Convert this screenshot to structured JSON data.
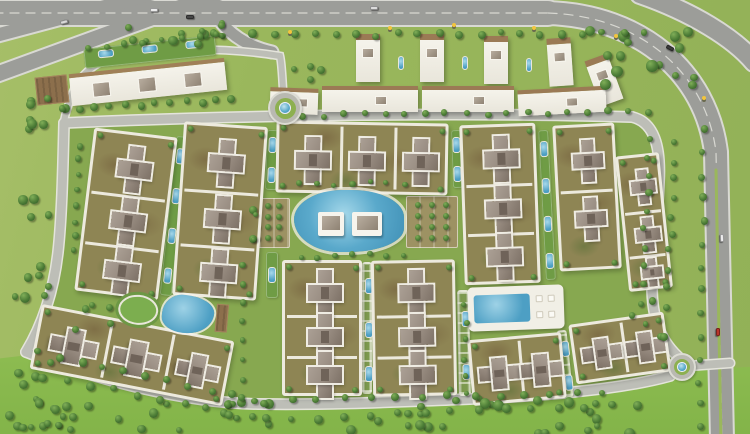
{
  "meta": {
    "alt": "Aerial master plan rendering of a gated residential compound: apartment clusters around a central lagoon pool and clubhouse, linear garden parks, perimeter loop road with two fountain roundabouts, commercial strip and villas row along a top highway, and tree-dotted green fields"
  },
  "palette": {
    "grass_base": "#9ab75c",
    "grass_field": "#8aba4e",
    "grass_inner": "#87a850",
    "road_major": "#9c9d99",
    "road_major_edge": "#d9d9d3",
    "road_minor": "#bdbeb7",
    "road_minor_edge": "#e4e4db",
    "plinth": "#edeade",
    "cluster_olive": "#8e8554",
    "cluster_brown": "#897a51",
    "building_gray": "#978b80",
    "building_dark": "#6f6359",
    "pool_blue": "#4d9fc4",
    "pool_light": "#a5d8ea",
    "tree_dark": "#2f5526",
    "tree_mid": "#4c7c36",
    "tree_light": "#7fae58",
    "garden_olive": "#9d9263",
    "deck_brown": "#8c6f4c",
    "white": "#f6f4ed"
  },
  "roads": {
    "interior": "M 66 122 C 240 114 470 111 632 117 C 656 122 662 148 659 184 C 656 232 652 262 652 288 C 652 318 662 342 684 360 C 640 384 545 397 470 400 C 392 403 330 406 258 405 C 186 404 96 380 28 352 C 45 322 55 288 59 252 C 63 216 65 164 66 122 Z",
    "major": [
      {
        "d": "M -6 13 L 548 13",
        "w": 24
      },
      {
        "d": "M 548 13 C 640 16 706 72 716 152 L 722 440",
        "w": 22
      },
      {
        "d": "M 640 -6 C 692 12 734 38 754 62",
        "w": 18
      },
      {
        "d": "M -6 36 L 152 -6",
        "w": 13
      },
      {
        "d": "M -8 76 L 228 -10",
        "w": 15
      },
      {
        "d": "M 206 -4 C 216 22 236 44 272 52",
        "w": 11
      }
    ],
    "lane_lines": [
      "M -6 13 L 548 13",
      "M 548 13 C 640 16 706 72 716 152 L 722 440"
    ],
    "median": {
      "d": "M 716 170 L 721 440",
      "w": 3
    },
    "minor": [
      {
        "d": "M 64 123 C 240 115 470 112 632 117",
        "w": 9
      },
      {
        "d": "M 632 117 C 654 122 661 146 659 182 C 657 230 652 262 652 286 C 652 318 660 342 682 360",
        "w": 9
      },
      {
        "d": "M 670 376 C 620 390 540 396 470 399 C 392 402 330 405 258 404 C 186 403 96 380 26 352",
        "w": 9
      },
      {
        "d": "M 26 352 C 44 322 54 288 58 252 C 62 216 63 164 64 123",
        "w": 9
      },
      {
        "d": "M 284 104 C 282 76 282 64 280 56 C 230 48 160 46 112 58",
        "w": 6
      },
      {
        "d": "M 112 58 C 90 64 76 80 70 100 C 67 110 65 114 64 122",
        "w": 6
      },
      {
        "d": "M 285 112 L 287 124",
        "w": 6
      },
      {
        "d": "M 688 366 L 730 363",
        "w": 8
      }
    ]
  },
  "roundabouts": [
    {
      "cx": 285,
      "cy": 108,
      "r": 17
    },
    {
      "cx": 682,
      "cy": 367,
      "r": 14
    }
  ],
  "clusters": [
    {
      "x": 84,
      "y": 132,
      "w": 84,
      "h": 164,
      "rot": 7,
      "crosses": [
        [
          42,
          34
        ],
        [
          42,
          86
        ],
        [
          42,
          136
        ]
      ],
      "div": [
        [
          "h",
          60
        ],
        [
          "h",
          111
        ]
      ]
    },
    {
      "x": 178,
      "y": 124,
      "w": 84,
      "h": 174,
      "rot": 4,
      "crosses": [
        [
          42,
          36
        ],
        [
          42,
          92
        ],
        [
          42,
          146
        ]
      ],
      "div": [
        [
          "h",
          64
        ],
        [
          "h",
          119
        ]
      ]
    },
    {
      "x": 276,
      "y": 122,
      "w": 172,
      "h": 72,
      "rot": 1,
      "crosses": [
        [
          34,
          36
        ],
        [
          88,
          36
        ],
        [
          142,
          36
        ]
      ],
      "div": [
        [
          "v",
          61
        ],
        [
          "v",
          115
        ]
      ]
    },
    {
      "x": 282,
      "y": 260,
      "w": 80,
      "h": 136,
      "rot": 0,
      "crosses": [
        [
          40,
          30
        ],
        [
          40,
          74
        ],
        [
          40,
          112
        ]
      ],
      "div": [
        [
          "h",
          52
        ],
        [
          "h",
          93
        ]
      ]
    },
    {
      "x": 372,
      "y": 260,
      "w": 84,
      "h": 136,
      "rot": -1,
      "crosses": [
        [
          42,
          30
        ],
        [
          42,
          74
        ],
        [
          42,
          112
        ]
      ],
      "div": [
        [
          "h",
          52
        ],
        [
          "h",
          93
        ]
      ]
    },
    {
      "x": 462,
      "y": 124,
      "w": 76,
      "h": 160,
      "rot": -2,
      "crosses": [
        [
          38,
          32
        ],
        [
          38,
          82
        ],
        [
          38,
          130
        ]
      ],
      "div": [
        [
          "h",
          57
        ],
        [
          "h",
          106
        ]
      ]
    },
    {
      "x": 556,
      "y": 124,
      "w": 62,
      "h": 146,
      "rot": -3,
      "crosses": [
        [
          31,
          34,
          0,
          0.9
        ],
        [
          31,
          92,
          0,
          0.9
        ]
      ],
      "div": [
        [
          "h",
          63
        ]
      ]
    },
    {
      "x": 622,
      "y": 154,
      "w": 44,
      "h": 136,
      "rot": -6,
      "crosses": [
        [
          22,
          30,
          0,
          0.72
        ],
        [
          22,
          78,
          0,
          0.72
        ],
        [
          22,
          116,
          0,
          0.6
        ]
      ],
      "div": [
        [
          "h",
          54
        ],
        [
          "h",
          98
        ]
      ]
    },
    {
      "x": 34,
      "y": 322,
      "w": 196,
      "h": 66,
      "rot": 11,
      "crosses": [
        [
          36,
          33,
          90
        ],
        [
          100,
          33,
          90
        ],
        [
          162,
          33,
          90,
          0.9
        ]
      ],
      "div": [
        [
          "v",
          68
        ],
        [
          "v",
          131
        ]
      ]
    },
    {
      "x": 470,
      "y": 336,
      "w": 94,
      "h": 66,
      "rot": -5,
      "crosses": [
        [
          26,
          33,
          90,
          0.9
        ],
        [
          68,
          33,
          90,
          0.9
        ]
      ],
      "div": [
        [
          "v",
          47
        ]
      ]
    },
    {
      "x": 572,
      "y": 318,
      "w": 96,
      "h": 60,
      "rot": -8,
      "crosses": [
        [
          26,
          30,
          90,
          0.85
        ],
        [
          70,
          30,
          90,
          0.85
        ]
      ],
      "div": [
        [
          "v",
          48
        ]
      ]
    }
  ],
  "parks": [
    {
      "x": 168,
      "y": 136,
      "w": 12,
      "h": 160,
      "rot": 6,
      "pools": 4
    },
    {
      "x": 266,
      "y": 130,
      "w": 12,
      "h": 60,
      "rot": 2,
      "pools": 2
    },
    {
      "x": 266,
      "y": 252,
      "w": 12,
      "h": 46,
      "rot": 0,
      "pools": 1
    },
    {
      "x": 362,
      "y": 262,
      "w": 10,
      "h": 132,
      "rot": 0,
      "pools": 3,
      "style": "ladder"
    },
    {
      "x": 458,
      "y": 290,
      "w": 12,
      "h": 106,
      "rot": -1,
      "pools": 2,
      "style": "ladder"
    },
    {
      "x": 452,
      "y": 130,
      "w": 10,
      "h": 58,
      "rot": -2,
      "pools": 2
    },
    {
      "x": 542,
      "y": 130,
      "w": 10,
      "h": 150,
      "rot": -3,
      "pools": 4
    },
    {
      "x": 560,
      "y": 330,
      "w": 10,
      "h": 68,
      "rot": -6,
      "pools": 2,
      "style": "ladder"
    }
  ],
  "gardens": [
    {
      "x": 246,
      "y": 198,
      "w": 44,
      "h": 50,
      "cols": 3,
      "rows": 4
    },
    {
      "x": 406,
      "y": 196,
      "w": 52,
      "h": 52,
      "cols": 3,
      "rows": 4
    }
  ],
  "lagoon": {
    "x": 294,
    "y": 190,
    "w": 110,
    "h": 62,
    "clubhouses": [
      [
        318,
        212,
        26,
        24
      ],
      [
        352,
        212,
        30,
        24
      ]
    ]
  },
  "amenity_left": {
    "x": 118,
    "y": 292,
    "w": 112,
    "h": 44,
    "rot": 5
  },
  "pool_right": {
    "x": 468,
    "y": 286,
    "w": 96,
    "h": 44,
    "rot": -2
  },
  "commercial": {
    "bld": {
      "x": 70,
      "y": 66,
      "w": 156,
      "h": 32,
      "rot": -6,
      "units": [
        22,
        68,
        114
      ]
    },
    "deck": {
      "x": 36,
      "y": 76,
      "w": 32,
      "h": 28,
      "rot": -6
    },
    "garden": {
      "x": 84,
      "y": 42,
      "w": 132,
      "h": 20,
      "rot": -6,
      "pools": 3
    }
  },
  "villas": {
    "towers": [
      [
        356,
        34,
        0
      ],
      [
        420,
        34,
        0
      ],
      [
        484,
        36,
        0
      ],
      [
        548,
        38,
        -4
      ],
      [
        592,
        56,
        -20
      ]
    ],
    "slabs": [
      [
        270,
        88,
        48,
        26,
        2
      ],
      [
        322,
        86,
        96,
        26,
        0
      ],
      [
        422,
        86,
        92,
        26,
        0
      ],
      [
        518,
        88,
        88,
        26,
        -3
      ]
    ],
    "mini_pools": [
      [
        398,
        56
      ],
      [
        462,
        56
      ],
      [
        526,
        58
      ]
    ]
  },
  "trees": {
    "scatter": [
      {
        "x": 10,
        "y": 396,
        "w": 630,
        "h": 34,
        "n": 46,
        "a": 3,
        "b": 5.5
      },
      {
        "x": 0,
        "y": 352,
        "w": 78,
        "h": 74,
        "n": 12,
        "a": 3,
        "b": 5
      },
      {
        "x": 584,
        "y": 22,
        "w": 118,
        "h": 62,
        "n": 15,
        "a": 3.5,
        "b": 6
      },
      {
        "x": 2,
        "y": 86,
        "w": 64,
        "h": 54,
        "n": 8,
        "a": 3,
        "b": 5.5
      },
      {
        "x": 160,
        "y": 18,
        "w": 66,
        "h": 26,
        "n": 6,
        "a": 3,
        "b": 5
      },
      {
        "x": 8,
        "y": 150,
        "w": 42,
        "h": 146,
        "n": 11,
        "a": 3,
        "b": 5.5
      },
      {
        "x": 70,
        "y": 298,
        "w": 42,
        "h": 36,
        "n": 5,
        "a": 2.5,
        "b": 4
      },
      {
        "x": 232,
        "y": 200,
        "w": 32,
        "h": 48,
        "n": 4,
        "a": 2.5,
        "b": 4
      },
      {
        "x": 286,
        "y": 58,
        "w": 36,
        "h": 22,
        "n": 4,
        "a": 2.5,
        "b": 4
      },
      {
        "x": 626,
        "y": 296,
        "w": 36,
        "h": 46,
        "n": 5,
        "a": 2.5,
        "b": 4
      },
      {
        "x": 118,
        "y": 24,
        "w": 110,
        "h": 14,
        "n": 7,
        "a": 2.5,
        "b": 4.5
      }
    ],
    "lines": [
      {
        "x1": 250,
        "y1": 31,
        "x2": 640,
        "y2": 30,
        "n": 20,
        "r": 3.8
      },
      {
        "x1": 300,
        "y1": 112,
        "x2": 646,
        "y2": 108,
        "n": 18,
        "r": 3.2
      },
      {
        "x1": 60,
        "y1": 106,
        "x2": 228,
        "y2": 96,
        "n": 12,
        "r": 3.6
      },
      {
        "x1": 34,
        "y1": 348,
        "x2": 250,
        "y2": 396,
        "n": 11,
        "r": 3.6
      },
      {
        "x1": 262,
        "y1": 398,
        "x2": 600,
        "y2": 388,
        "n": 14,
        "r": 3.6
      },
      {
        "x1": 16,
        "y1": 368,
        "x2": 250,
        "y2": 414,
        "n": 11,
        "r": 3.8
      },
      {
        "x1": 262,
        "y1": 416,
        "x2": 634,
        "y2": 400,
        "n": 15,
        "r": 3.8
      },
      {
        "x1": 646,
        "y1": 136,
        "x2": 638,
        "y2": 300,
        "n": 10,
        "r": 3.2
      },
      {
        "x1": 672,
        "y1": 140,
        "x2": 664,
        "y2": 302,
        "n": 10,
        "r": 3.2
      },
      {
        "x1": 700,
        "y1": 126,
        "x2": 696,
        "y2": 424,
        "n": 14,
        "r": 3.4
      },
      {
        "x1": 86,
        "y1": 44,
        "x2": 214,
        "y2": 32,
        "n": 8,
        "r": 3
      },
      {
        "x1": 76,
        "y1": 142,
        "x2": 70,
        "y2": 248,
        "n": 8,
        "r": 3
      },
      {
        "x1": 298,
        "y1": 182,
        "x2": 402,
        "y2": 180,
        "n": 7,
        "r": 2.8
      },
      {
        "x1": 298,
        "y1": 254,
        "x2": 402,
        "y2": 252,
        "n": 7,
        "r": 2.8
      },
      {
        "x1": 462,
        "y1": 300,
        "x2": 462,
        "y2": 392,
        "n": 6,
        "r": 2.6
      },
      {
        "x1": 238,
        "y1": 262,
        "x2": 238,
        "y2": 396,
        "n": 8,
        "r": 3
      }
    ]
  },
  "cars": [
    {
      "x": 150,
      "y": 8,
      "rot": 0,
      "c": "#ececec"
    },
    {
      "x": 186,
      "y": 15,
      "rot": 0,
      "c": "#474747"
    },
    {
      "x": 370,
      "y": 6,
      "rot": 0,
      "c": "#dcdcdc"
    },
    {
      "x": 666,
      "y": 46,
      "rot": 28,
      "c": "#3c3c3c"
    },
    {
      "x": 718,
      "y": 236,
      "rot": 88,
      "c": "#ececec"
    },
    {
      "x": 714,
      "y": 330,
      "rot": 90,
      "c": "#b8352b"
    },
    {
      "x": 60,
      "y": 20,
      "rot": -15,
      "c": "#d9d9d9"
    }
  ],
  "signals": [
    {
      "x": 388,
      "y": 26
    },
    {
      "x": 452,
      "y": 23
    },
    {
      "x": 532,
      "y": 26
    },
    {
      "x": 614,
      "y": 34
    },
    {
      "x": 702,
      "y": 96
    },
    {
      "x": 288,
      "y": 30
    }
  ]
}
